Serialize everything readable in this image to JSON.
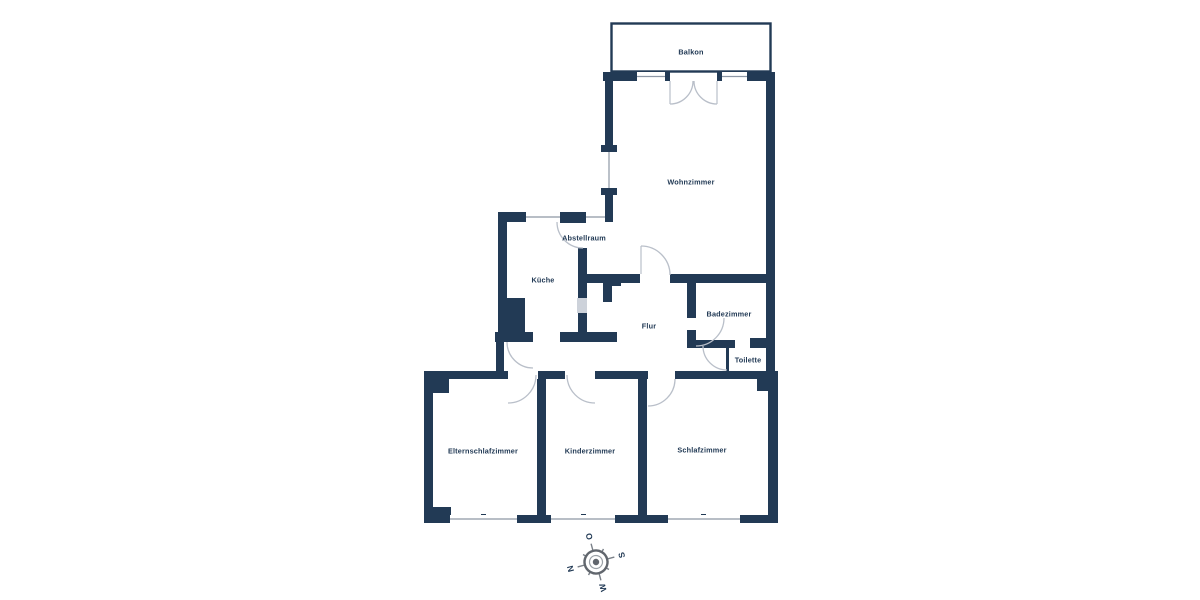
{
  "plan": {
    "background": "#ffffff",
    "wall_color": "#223a55",
    "door_arc_color": "#b9bfc9",
    "window_line_color": "#8d97a5",
    "hatch_color": "#cdd2da",
    "compass_color": "#61666d"
  },
  "rooms": {
    "balkon": {
      "label": "Balkon"
    },
    "wohnzimmer": {
      "label": "Wohnzimmer"
    },
    "abstellraum": {
      "label": "Abstellraum"
    },
    "kueche": {
      "label": "Küche"
    },
    "flur": {
      "label": "Flur"
    },
    "badezimmer": {
      "label": "Badezimmer"
    },
    "toilette": {
      "label": "Toilette"
    },
    "elternschlafzimmer": {
      "label": "Elternschlafzimmer"
    },
    "kinderzimmer": {
      "label": "Kinderzimmer"
    },
    "schlafzimmer": {
      "label": "Schlafzimmer"
    }
  },
  "compass": {
    "north": "N",
    "east": "O",
    "south": "S",
    "west": "W"
  }
}
